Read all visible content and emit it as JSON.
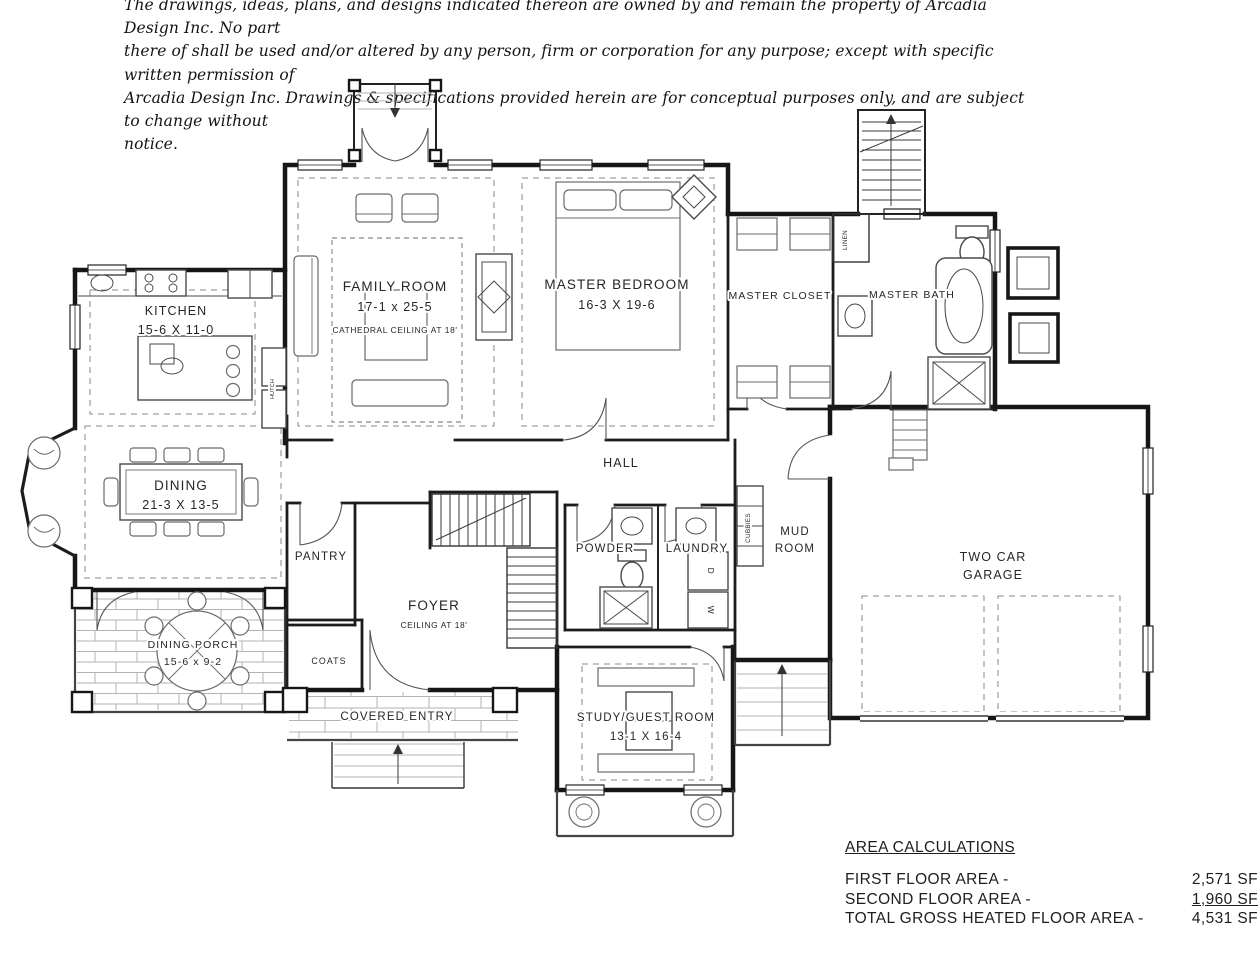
{
  "disclaimer": {
    "lines": [
      "The drawings, ideas, plans, and designs indicated thereon are owned by and remain the property of Arcadia Design Inc. No part",
      "there of shall be used and/or altered by any person, firm or corporation for any purpose; except with specific written permission of",
      "Arcadia Design Inc. Drawings & specifications provided herein are for conceptual purposes only, and are subject to change without",
      "notice."
    ]
  },
  "rooms": {
    "family_room": {
      "name": "FAMILY ROOM",
      "dims": "17-1 x 25-5",
      "note": "CATHEDRAL CEILING AT 18'"
    },
    "master_bedroom": {
      "name": "MASTER BEDROOM",
      "dims": "16-3 X 19-6"
    },
    "master_closet": {
      "name": "MASTER CLOSET"
    },
    "master_bath": {
      "name": "MASTER BATH"
    },
    "kitchen": {
      "name": "KITCHEN",
      "dims": "15-6 X 11-0"
    },
    "dining": {
      "name": "DINING",
      "dims": "21-3 X 13-5"
    },
    "hall": {
      "name": "HALL"
    },
    "pantry": {
      "name": "PANTRY"
    },
    "foyer": {
      "name": "FOYER",
      "note": "CEILING AT 18'"
    },
    "powder": {
      "name": "POWDER"
    },
    "laundry": {
      "name": "LAUNDRY"
    },
    "mud_room": {
      "line1": "MUD",
      "line2": "ROOM"
    },
    "garage": {
      "line1": "TWO CAR",
      "line2": "GARAGE"
    },
    "dining_porch": {
      "name": "DINING PORCH",
      "dims": "15-6 x 9-2"
    },
    "coats": {
      "name": "COATS"
    },
    "covered_entry": {
      "name": "COVERED ENTRY"
    },
    "study": {
      "name": "STUDY/GUEST ROOM",
      "dims": "13-1 X 16-4"
    }
  },
  "annotations": {
    "cubbies": "CUBBIES",
    "linen": "LINEN",
    "hutch": "HUTCH",
    "washer": "W",
    "dryer": "D"
  },
  "area_calculations": {
    "title": "AREA CALCULATIONS",
    "rows": [
      {
        "label": "FIRST FLOOR AREA -",
        "value": "2,571 SF"
      },
      {
        "label": "SECOND FLOOR AREA -",
        "value": "1,960 SF"
      },
      {
        "label": "TOTAL GROSS HEATED FLOOR AREA -",
        "value": "4,531 SF"
      }
    ]
  }
}
